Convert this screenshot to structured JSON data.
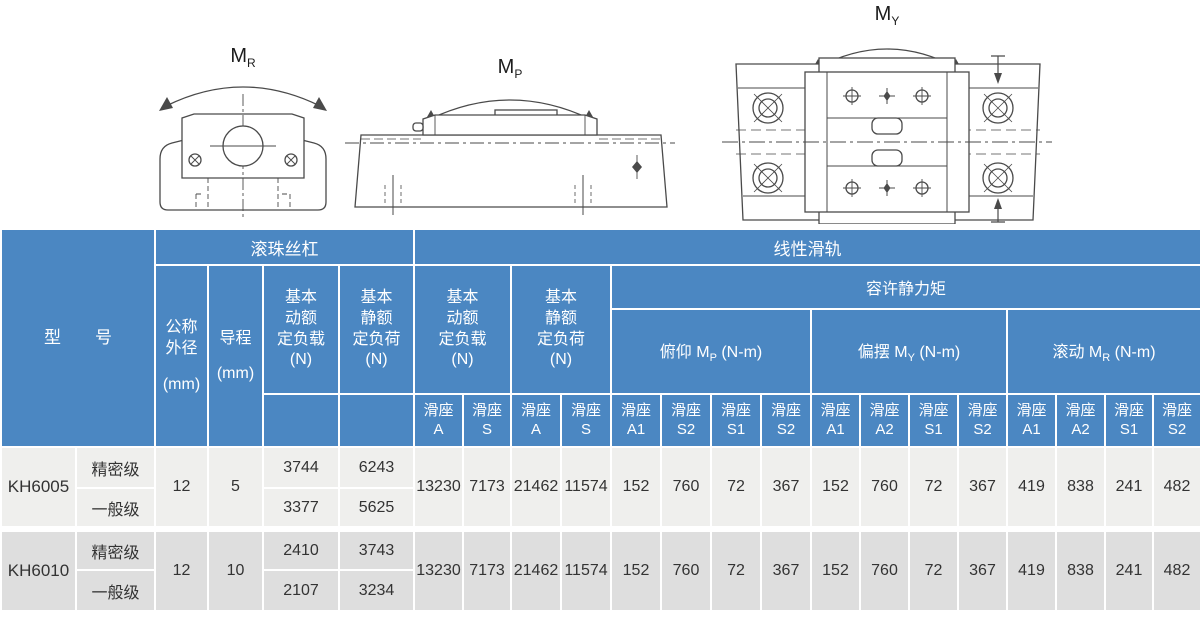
{
  "diagrams": {
    "roll": {
      "label": "M",
      "sub": "R"
    },
    "pitch": {
      "label": "M",
      "sub": "P"
    },
    "yaw": {
      "label": "M",
      "sub": "Y"
    }
  },
  "table": {
    "header": {
      "model": "型　　号",
      "ball_screw_group": "滚珠丝杠",
      "linear_guide_group": "线性滑轨",
      "nominal_od": "公称\n外径",
      "nominal_od_unit": "(mm)",
      "lead": "导程",
      "lead_unit": "(mm)",
      "bs_dynamic": "基本\n动额\n定负载\n(N)",
      "bs_static": "基本\n静额\n定负荷\n(N)",
      "lg_dynamic": "基本\n动额\n定负载\n(N)",
      "lg_static": "基本\n静额\n定负荷\n(N)",
      "static_moment_group": "容许静力矩",
      "moments": [
        {
          "prefix": "俯仰 M",
          "sub": "P",
          "suffix": " (N-m)"
        },
        {
          "prefix": "偏摆 M",
          "sub": "Y",
          "suffix": " (N-m)"
        },
        {
          "prefix": "滚动 M",
          "sub": "R",
          "suffix": " (N-m)"
        }
      ],
      "slide_cols": [
        "滑座\nA",
        "滑座\nS",
        "滑座\nA",
        "滑座\nS",
        "滑座\nA1",
        "滑座\nS2",
        "滑座\nS1",
        "滑座\nS2",
        "滑座\nA1",
        "滑座\nA2",
        "滑座\nS1",
        "滑座\nS2",
        "滑座\nA1",
        "滑座\nA2",
        "滑座\nS1",
        "滑座\nS2"
      ]
    },
    "rows": [
      {
        "model": "KH6005",
        "od": "12",
        "lead": "5",
        "grades": [
          {
            "grade": "精密级",
            "bs_dynamic": "3744",
            "bs_static": "6243"
          },
          {
            "grade": "一般级",
            "bs_dynamic": "3377",
            "bs_static": "5625"
          }
        ],
        "shared": [
          "13230",
          "7173",
          "21462",
          "11574",
          "152",
          "760",
          "72",
          "367",
          "152",
          "760",
          "72",
          "367",
          "419",
          "838",
          "241",
          "482"
        ]
      },
      {
        "model": "KH6010",
        "od": "12",
        "lead": "10",
        "grades": [
          {
            "grade": "精密级",
            "bs_dynamic": "2410",
            "bs_static": "3743"
          },
          {
            "grade": "一般级",
            "bs_dynamic": "2107",
            "bs_static": "3234"
          }
        ],
        "shared": [
          "13230",
          "7173",
          "21462",
          "11574",
          "152",
          "760",
          "72",
          "367",
          "152",
          "760",
          "72",
          "367",
          "419",
          "838",
          "241",
          "482"
        ]
      }
    ]
  },
  "colors": {
    "header_blue": "#4B87C2",
    "row_light": "#EFEFED",
    "row_dark": "#DEDEDE",
    "grid_white": "#FFFFFF",
    "drawing_line": "#4A4A4A",
    "text_dark": "#333333"
  }
}
